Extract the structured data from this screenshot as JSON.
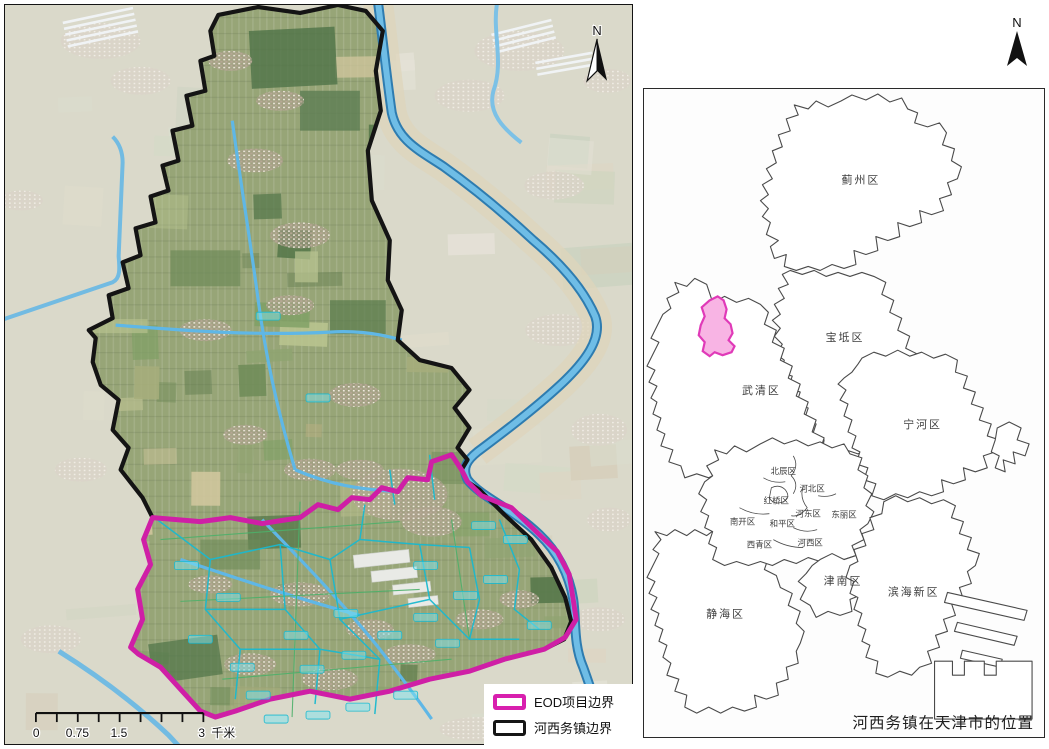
{
  "left_map": {
    "north_label": "N",
    "scale_bar": {
      "tick_labels": [
        "0",
        "0.75",
        "1.5",
        "3"
      ],
      "unit_label": "千米"
    },
    "legend": {
      "items": [
        {
          "label": "EOD项目边界",
          "color": "#d81fae"
        },
        {
          "label": "河西务镇边界",
          "color": "#151515"
        }
      ]
    },
    "boundary_colors": {
      "eod": "#cf1fa6",
      "town": "#141414",
      "river": "#6fbde6",
      "village_line": "#1ab9cf"
    }
  },
  "right_map": {
    "north_label": "N",
    "caption": "河西务镇在天津市的位置",
    "highlight": {
      "fill": "#f8b4e4",
      "stroke": "#e03ab8"
    },
    "districts": [
      {
        "name": "蓟州区"
      },
      {
        "name": "宝坻区"
      },
      {
        "name": "武清区"
      },
      {
        "name": "宁河区"
      },
      {
        "name": "北辰区"
      },
      {
        "name": "河北区"
      },
      {
        "name": "红桥区"
      },
      {
        "name": "河东区"
      },
      {
        "name": "东丽区"
      },
      {
        "name": "南开区"
      },
      {
        "name": "和平区"
      },
      {
        "name": "西青区"
      },
      {
        "name": "河西区"
      },
      {
        "name": "津南区"
      },
      {
        "name": "滨海新区"
      },
      {
        "name": "静海区"
      }
    ]
  }
}
